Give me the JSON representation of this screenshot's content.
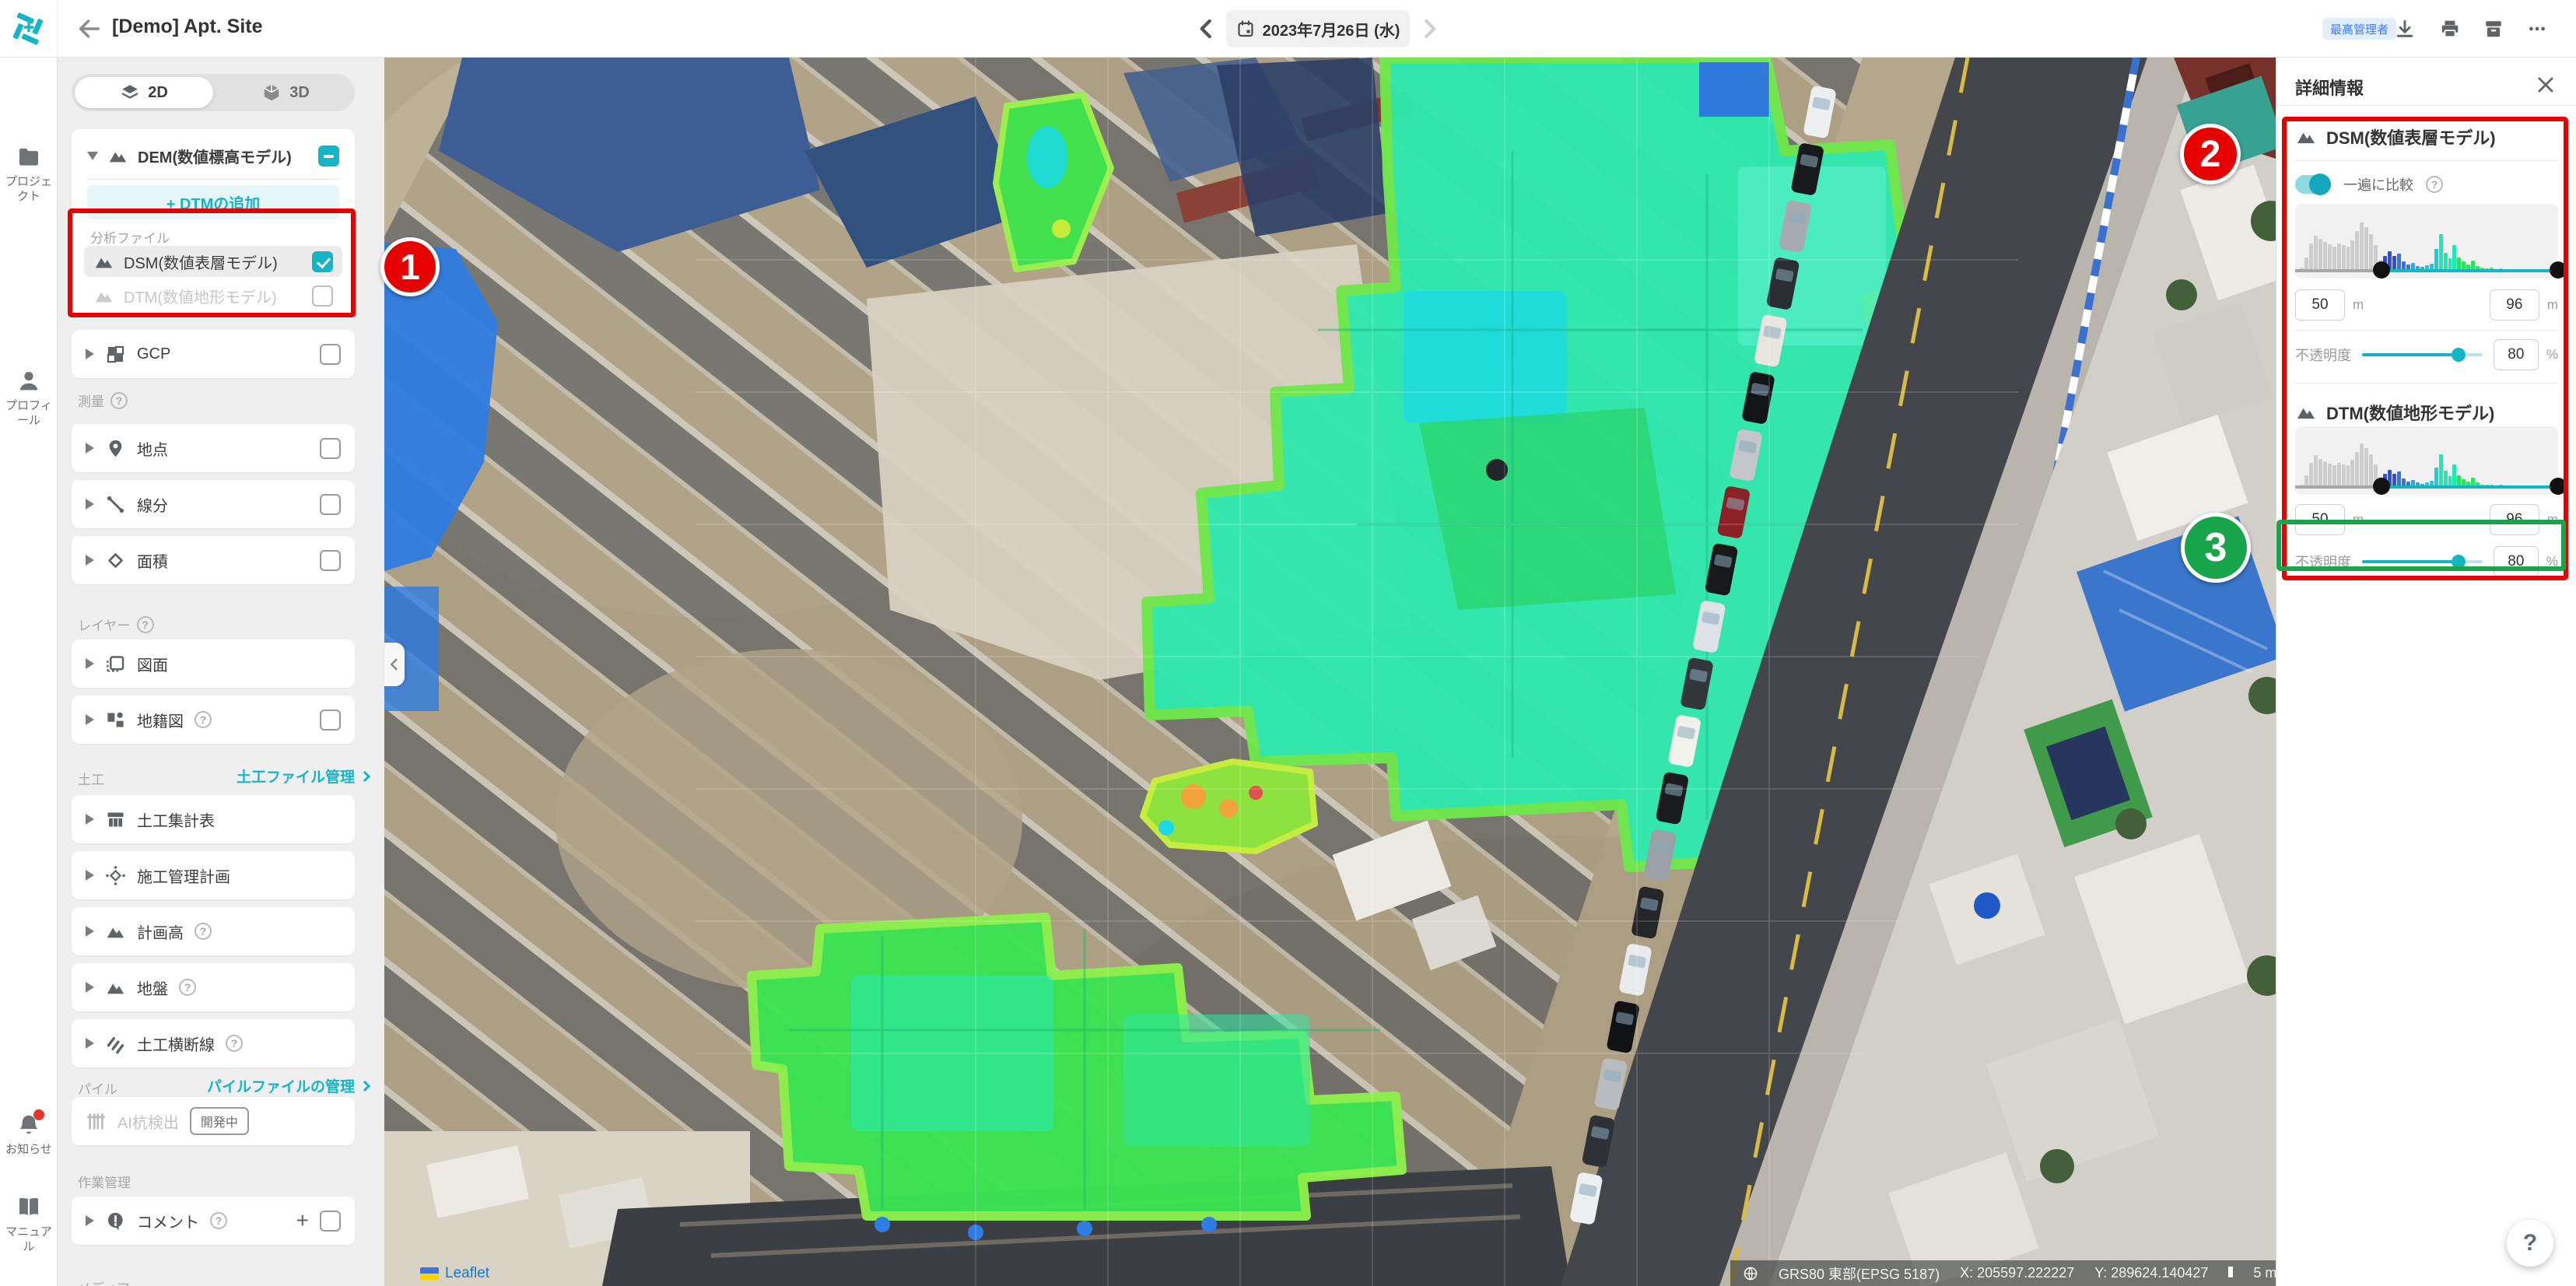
{
  "topbar": {
    "title": "[Demo] Apt. Site",
    "date": "2023年7月26日 (水)",
    "role_badge": "最高管理者"
  },
  "rail": {
    "projects": "プロジェクト",
    "profile": "プロフィール",
    "notifications": "お知らせ",
    "manual": "マニュアル"
  },
  "sidebar": {
    "view2d": "2D",
    "view3d": "3D",
    "dem": {
      "title": "DEM(数値標高モデル)",
      "state": "indeterminate",
      "add_dtm": "+ DTMの追加",
      "files_label": "分析ファイル",
      "dsm": "DSM(数値表層モデル)",
      "dsm_state": "checked",
      "dtm": "DTM(数値地形モデル)",
      "dtm_state": "unchecked"
    },
    "gcp": "GCP",
    "survey_label": "測量",
    "point": "地点",
    "segment": "線分",
    "area": "面積",
    "layers_label": "レイヤー",
    "drawing": "図面",
    "cadastral": "地籍図",
    "earthwork_label": "土工",
    "earthwork_link": "土工ファイル管理",
    "earthwork_items": [
      "土工集計表",
      "施工管理計画",
      "計画高",
      "地盤",
      "土工横断線"
    ],
    "pile_label": "パイル",
    "pile_link": "パイルファイルの管理",
    "ai_pile": "AI杭検出",
    "ai_badge": "開発中",
    "work_label": "作業管理",
    "comment": "コメント",
    "media_label": "メディア"
  },
  "map": {
    "compare_label": "現場比較",
    "tools_label": "ツールを追加する",
    "status": {
      "crs": "GRS80 東部(EPSG 5187)",
      "x": "X: 205597.222227",
      "y": "Y: 289624.140427",
      "scale": "5 m"
    },
    "attribution": "Leaflet"
  },
  "panel": {
    "title": "詳細情報",
    "dsm": {
      "title": "DSM(数値表層モデル)",
      "toggle": "一遍に比較",
      "min": "50",
      "max": "96",
      "unit": "m",
      "opacity_label": "不透明度",
      "opacity": "80",
      "pct": "%"
    },
    "dtm": {
      "title": "DTM(数値地形モデル)",
      "min": "50",
      "max": "96",
      "unit": "m",
      "opacity_label": "不透明度",
      "opacity": "80",
      "pct": "%"
    }
  },
  "annotations": {
    "n1": "1",
    "n2": "2",
    "n3": "3"
  },
  "histogram": {
    "min_frac": 0.327,
    "bars": [
      0.05,
      0.22,
      0.45,
      0.58,
      0.52,
      0.47,
      0.43,
      0.4,
      0.45,
      0.42,
      0.4,
      0.5,
      0.65,
      0.8,
      0.72,
      0.6,
      0.42,
      0.18,
      0.25,
      0.32,
      0.24,
      0.28,
      0.16,
      0.1,
      0.13,
      0.08,
      0.06,
      0.09,
      0.12,
      0.36,
      0.6,
      0.3,
      0.2,
      0.42,
      0.22,
      0.15,
      0.1,
      0.17,
      0.08,
      0.05,
      0.04,
      0.05,
      0.03,
      0.04,
      0.025,
      0.03,
      0.02,
      0.02,
      0.015,
      0.02,
      0.012,
      0.01,
      0.01,
      0.008,
      0.006
    ]
  },
  "colors": {
    "accent": "#14b5c4",
    "annotation_red": "#e60000",
    "annotation_green": "#18a44a",
    "badge_blue": "#3e7bfa"
  }
}
